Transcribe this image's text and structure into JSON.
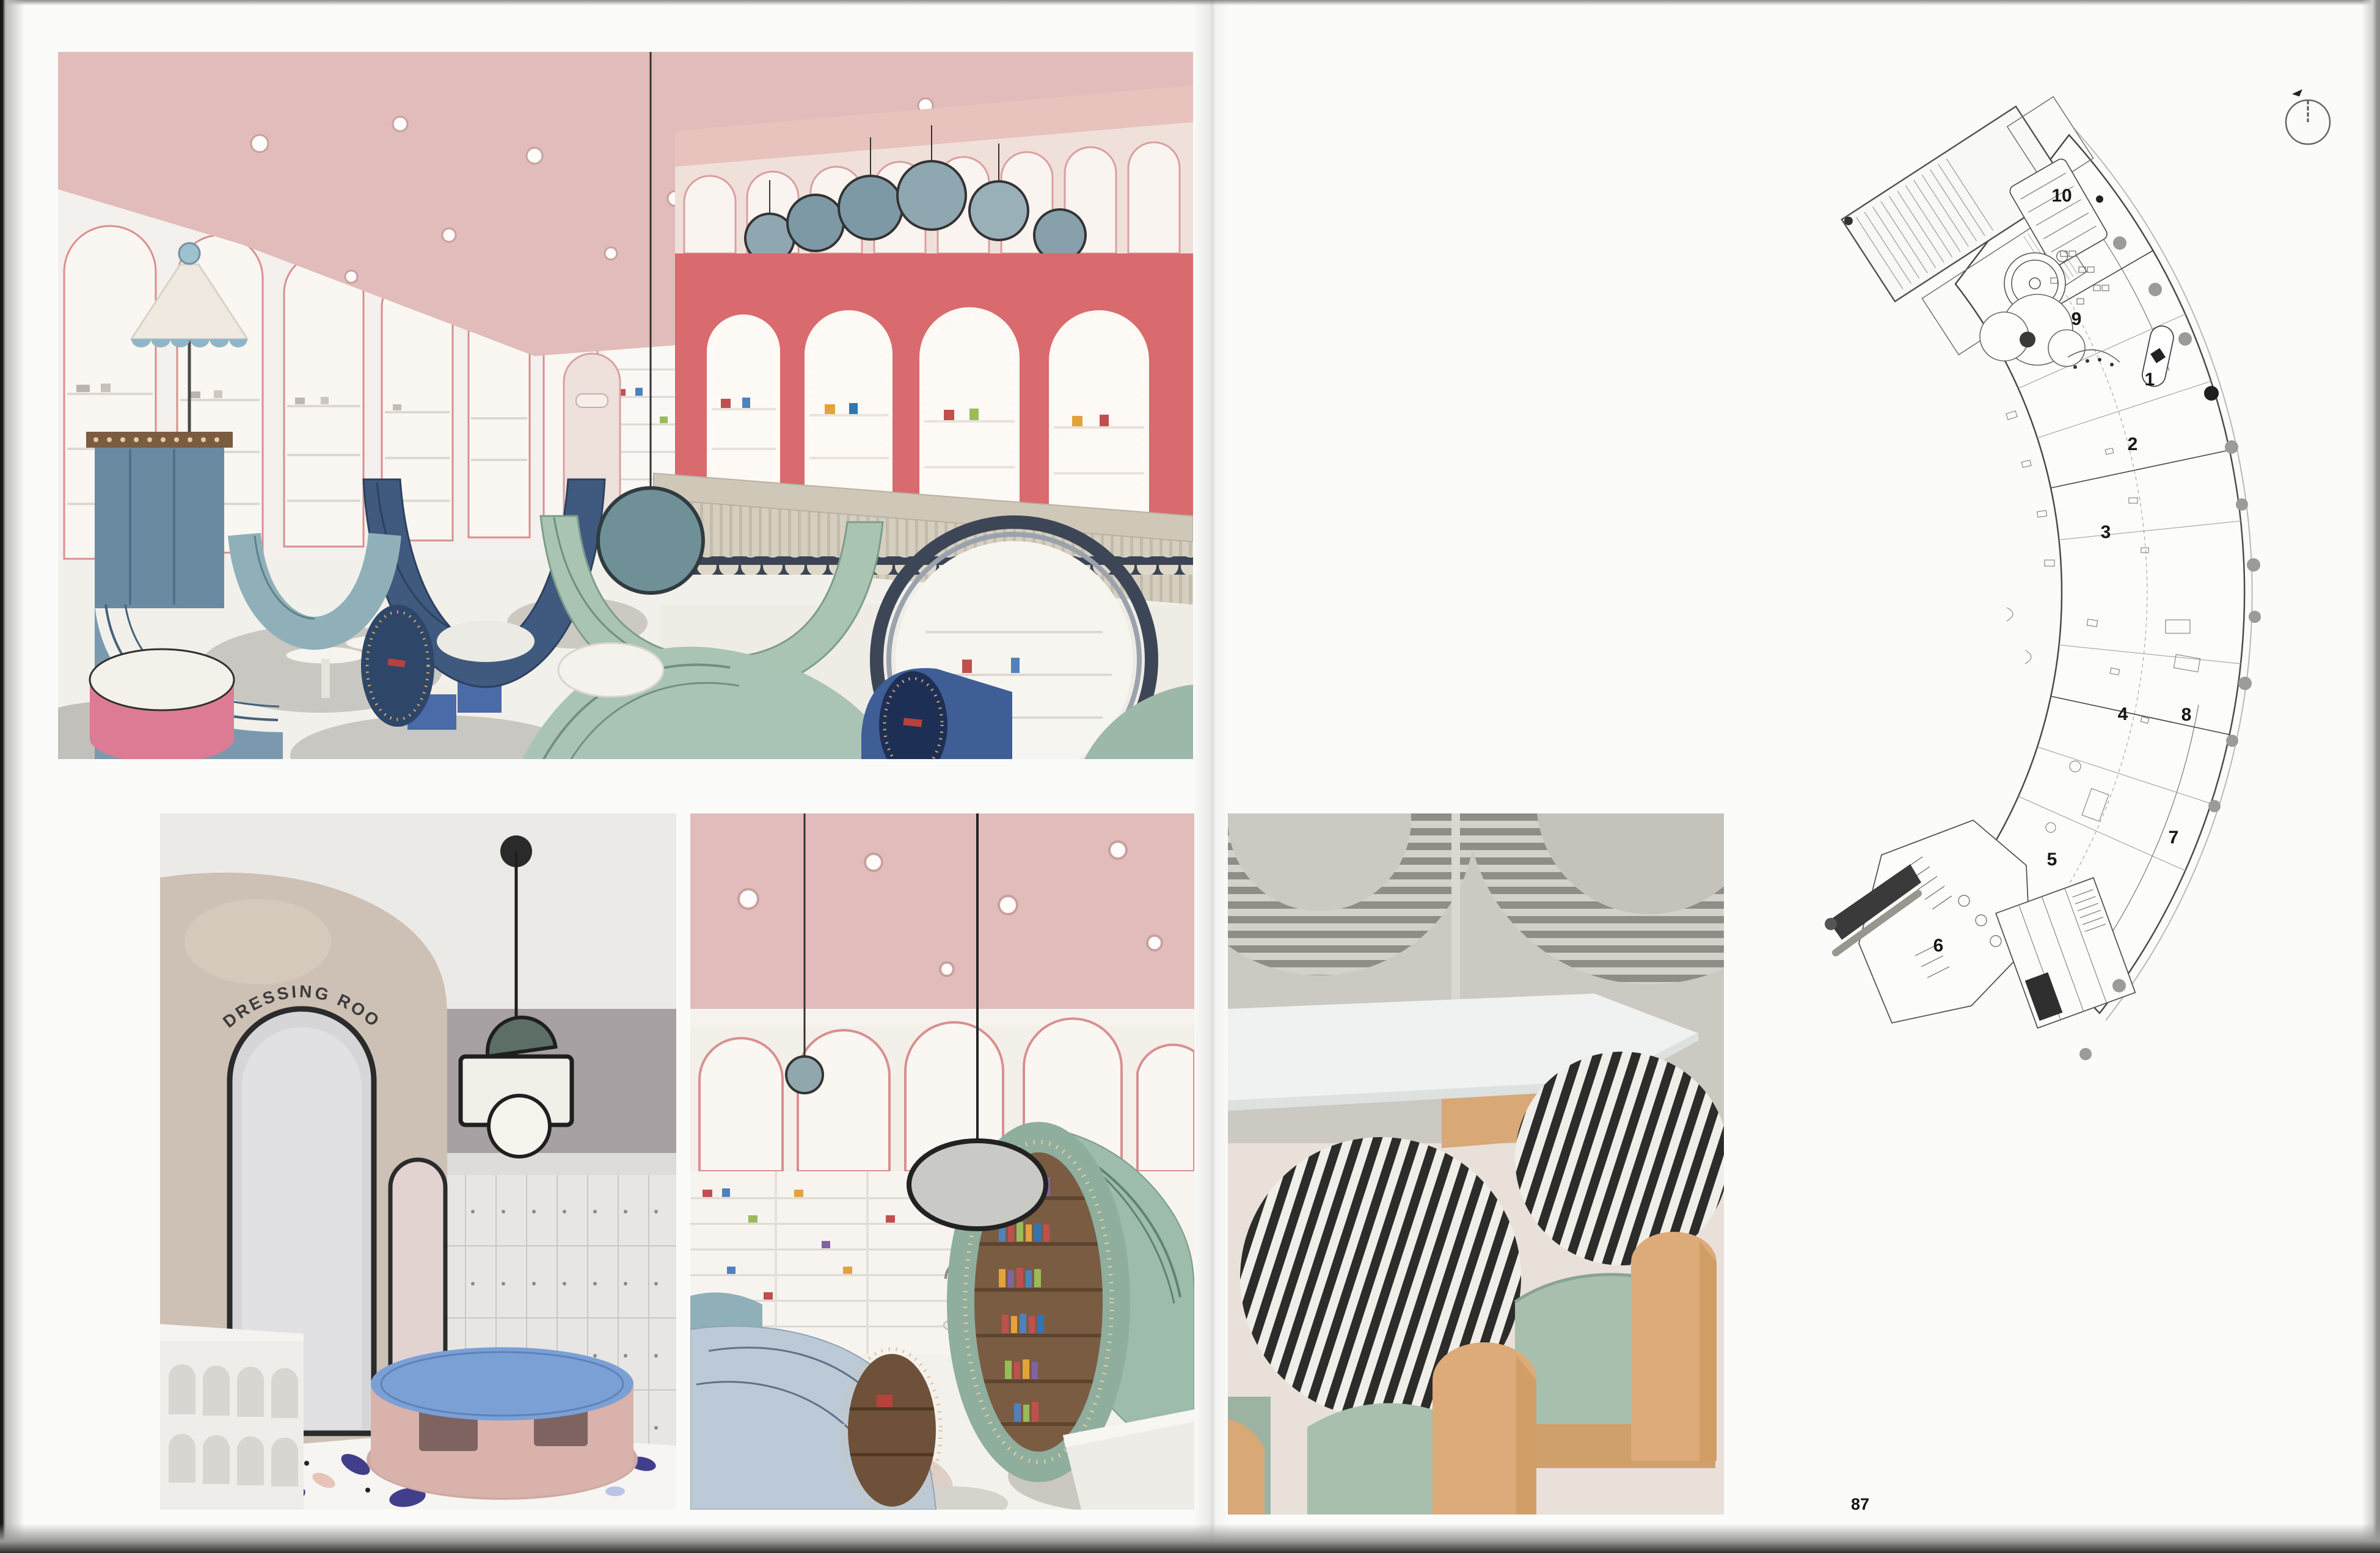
{
  "caption": {
    "lines": [
      "On the left: reading area (top), adult bath area,",
      "reading room, and rest area (bottom from left",
      "to right).",
      "On the right: general plan."
    ]
  },
  "legend": {
    "items": [
      {
        "num": "1.",
        "label": "reception"
      },
      {
        "num": "2.",
        "label": "shoe exchange area"
      },
      {
        "num": "3.",
        "label": "reading area"
      },
      {
        "num": "4.",
        "label": "swimming area"
      },
      {
        "num": "5.",
        "label": "baby bath area"
      },
      {
        "num": "6.",
        "label": "adult bath area"
      },
      {
        "num": "7.",
        "label": "water playing area"
      },
      {
        "num": "8.",
        "label": "parent rest area"
      },
      {
        "num": "9.",
        "label": "restaurant area"
      },
      {
        "num": "10.",
        "label": "party room"
      }
    ]
  },
  "plan": {
    "labels": [
      "10",
      "9",
      "1",
      "2",
      "3",
      "4",
      "8",
      "7",
      "5",
      "6"
    ],
    "scale_labels": [
      "0",
      "5",
      "10"
    ]
  },
  "photos": {
    "dressing_sign": "DRESSING ROOM"
  },
  "page_number": "87",
  "colors": {
    "ceiling_pink": "#e2bcba",
    "accent_coral": "#d96a6e",
    "arch_trim": "#d98f8f",
    "steel_blue": "#6f8fa6",
    "navy": "#3f5a7e",
    "sage_green": "#a9c4b4",
    "teal": "#8fb0b8",
    "pink_ottoman": "#dd7b95",
    "table_blue": "#7ba0d6",
    "wood": "#dcab79",
    "stripe_dark": "#2c2c2a"
  }
}
